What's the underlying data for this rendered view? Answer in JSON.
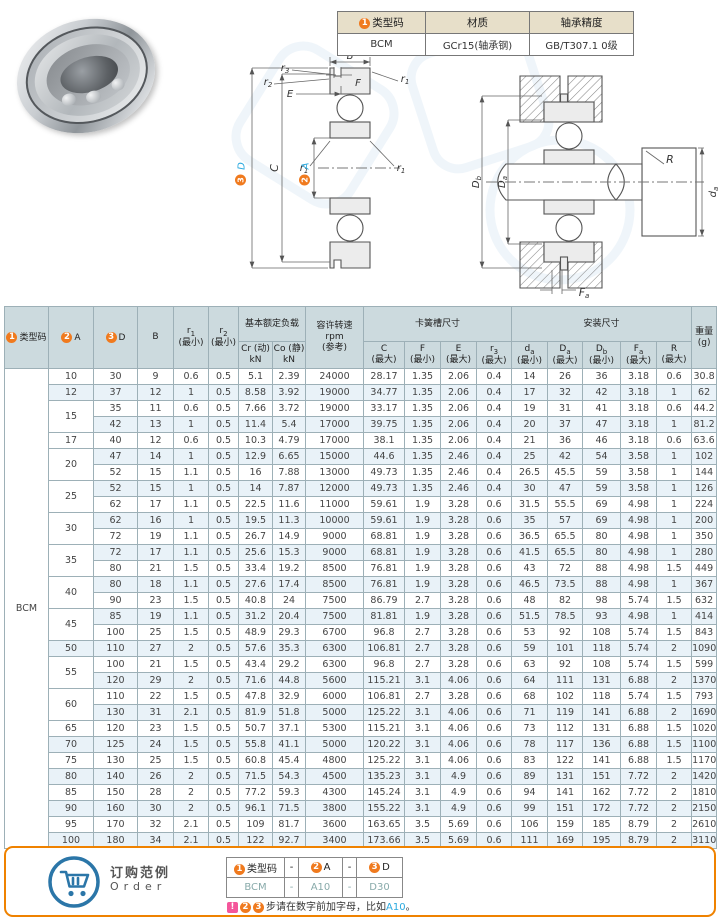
{
  "colors": {
    "accent_cyan": "#2aa9df",
    "accent_orange": "#f07a1e",
    "table_header_bg": "#ccdade",
    "row_alt_bg": "#e9f2f8",
    "info_header_bg": "#e7dfc9",
    "panel_border": "#ef8200",
    "warn_pink": "#f4569b",
    "cart_blue": "#2b76a8"
  },
  "info": {
    "h1": "类型码",
    "h2": "材质",
    "h3": "轴承精度",
    "v1": "BCM",
    "v2": "GCr15(轴承钢)",
    "v3": "GB/T307.1 0级"
  },
  "badges": {
    "b1": "1",
    "b2": "2",
    "b3": "3"
  },
  "th": {
    "typecode": "类型码",
    "colA": "A",
    "colD": "D",
    "colB": "B",
    "r": "r",
    "s1": "1",
    "s2": "2",
    "s3": "3",
    "min": "(最小)",
    "max": "(最大)",
    "load_group": "基本额定负载",
    "cr1": "Cr (动)",
    "co1": "Co (静)",
    "kn": "kN",
    "speed1": "容许转速",
    "speed2": "rpm",
    "speed3": "(参考)",
    "snap_group": "卡簧槽尺寸",
    "c": "C",
    "f": "F",
    "e": "E",
    "mount_group": "安装尺寸",
    "dlow": "d",
    "dup": "D",
    "fup": "F",
    "R": "R",
    "sa": "a",
    "sb": "b",
    "weight1": "重量",
    "weight2": "(g)"
  },
  "main_table": {
    "type_code": "BCM",
    "rows": [
      [
        "10",
        1,
        "30",
        "9",
        "0.6",
        "0.5",
        "5.1",
        "2.39",
        "24000",
        "28.17",
        "1.35",
        "2.06",
        "0.4",
        "14",
        "26",
        "36",
        "3.18",
        "0.6",
        "30.8"
      ],
      [
        "12",
        1,
        "37",
        "12",
        "1",
        "0.5",
        "8.58",
        "3.92",
        "19000",
        "34.77",
        "1.35",
        "2.06",
        "0.4",
        "17",
        "32",
        "42",
        "3.18",
        "1",
        "62"
      ],
      [
        "15",
        2,
        "35",
        "11",
        "0.6",
        "0.5",
        "7.66",
        "3.72",
        "19000",
        "33.17",
        "1.35",
        "2.06",
        "0.4",
        "19",
        "31",
        "41",
        "3.18",
        "0.6",
        "44.2"
      ],
      [
        null,
        0,
        "42",
        "13",
        "1",
        "0.5",
        "11.4",
        "5.4",
        "17000",
        "39.75",
        "1.35",
        "2.06",
        "0.4",
        "20",
        "37",
        "47",
        "3.18",
        "1",
        "81.2"
      ],
      [
        "17",
        1,
        "40",
        "12",
        "0.6",
        "0.5",
        "10.3",
        "4.79",
        "17000",
        "38.1",
        "1.35",
        "2.06",
        "0.4",
        "21",
        "36",
        "46",
        "3.18",
        "0.6",
        "63.6"
      ],
      [
        "20",
        2,
        "47",
        "14",
        "1",
        "0.5",
        "12.9",
        "6.65",
        "15000",
        "44.6",
        "1.35",
        "2.46",
        "0.4",
        "25",
        "42",
        "54",
        "3.58",
        "1",
        "102"
      ],
      [
        null,
        0,
        "52",
        "15",
        "1.1",
        "0.5",
        "16",
        "7.88",
        "13000",
        "49.73",
        "1.35",
        "2.46",
        "0.4",
        "26.5",
        "45.5",
        "59",
        "3.58",
        "1",
        "144"
      ],
      [
        "25",
        2,
        "52",
        "15",
        "1",
        "0.5",
        "14",
        "7.87",
        "12000",
        "49.73",
        "1.35",
        "2.46",
        "0.4",
        "30",
        "47",
        "59",
        "3.58",
        "1",
        "126"
      ],
      [
        null,
        0,
        "62",
        "17",
        "1.1",
        "0.5",
        "22.5",
        "11.6",
        "11000",
        "59.61",
        "1.9",
        "3.28",
        "0.6",
        "31.5",
        "55.5",
        "69",
        "4.98",
        "1",
        "224"
      ],
      [
        "30",
        2,
        "62",
        "16",
        "1",
        "0.5",
        "19.5",
        "11.3",
        "10000",
        "59.61",
        "1.9",
        "3.28",
        "0.6",
        "35",
        "57",
        "69",
        "4.98",
        "1",
        "200"
      ],
      [
        null,
        0,
        "72",
        "19",
        "1.1",
        "0.5",
        "26.7",
        "14.9",
        "9000",
        "68.81",
        "1.9",
        "3.28",
        "0.6",
        "36.5",
        "65.5",
        "80",
        "4.98",
        "1",
        "350"
      ],
      [
        "35",
        2,
        "72",
        "17",
        "1.1",
        "0.5",
        "25.6",
        "15.3",
        "9000",
        "68.81",
        "1.9",
        "3.28",
        "0.6",
        "41.5",
        "65.5",
        "80",
        "4.98",
        "1",
        "280"
      ],
      [
        null,
        0,
        "80",
        "21",
        "1.5",
        "0.5",
        "33.4",
        "19.2",
        "8500",
        "76.81",
        "1.9",
        "3.28",
        "0.6",
        "43",
        "72",
        "88",
        "4.98",
        "1.5",
        "449"
      ],
      [
        "40",
        2,
        "80",
        "18",
        "1.1",
        "0.5",
        "27.6",
        "17.4",
        "8500",
        "76.81",
        "1.9",
        "3.28",
        "0.6",
        "46.5",
        "73.5",
        "88",
        "4.98",
        "1",
        "367"
      ],
      [
        null,
        0,
        "90",
        "23",
        "1.5",
        "0.5",
        "40.8",
        "24",
        "7500",
        "86.79",
        "2.7",
        "3.28",
        "0.6",
        "48",
        "82",
        "98",
        "5.74",
        "1.5",
        "632"
      ],
      [
        "45",
        2,
        "85",
        "19",
        "1.1",
        "0.5",
        "31.2",
        "20.4",
        "7500",
        "81.81",
        "1.9",
        "3.28",
        "0.6",
        "51.5",
        "78.5",
        "93",
        "4.98",
        "1",
        "414"
      ],
      [
        null,
        0,
        "100",
        "25",
        "1.5",
        "0.5",
        "48.9",
        "29.3",
        "6700",
        "96.8",
        "2.7",
        "3.28",
        "0.6",
        "53",
        "92",
        "108",
        "5.74",
        "1.5",
        "843"
      ],
      [
        "50",
        1,
        "110",
        "27",
        "2",
        "0.5",
        "57.6",
        "35.3",
        "6300",
        "106.81",
        "2.7",
        "3.28",
        "0.6",
        "59",
        "101",
        "118",
        "5.74",
        "2",
        "1090"
      ],
      [
        "55",
        2,
        "100",
        "21",
        "1.5",
        "0.5",
        "43.4",
        "29.2",
        "6300",
        "96.8",
        "2.7",
        "3.28",
        "0.6",
        "63",
        "92",
        "108",
        "5.74",
        "1.5",
        "599"
      ],
      [
        null,
        0,
        "120",
        "29",
        "2",
        "0.5",
        "71.6",
        "44.8",
        "5600",
        "115.21",
        "3.1",
        "4.06",
        "0.6",
        "64",
        "111",
        "131",
        "6.88",
        "2",
        "1370"
      ],
      [
        "60",
        2,
        "110",
        "22",
        "1.5",
        "0.5",
        "47.8",
        "32.9",
        "6000",
        "106.81",
        "2.7",
        "3.28",
        "0.6",
        "68",
        "102",
        "118",
        "5.74",
        "1.5",
        "793"
      ],
      [
        null,
        0,
        "130",
        "31",
        "2.1",
        "0.5",
        "81.9",
        "51.8",
        "5000",
        "125.22",
        "3.1",
        "4.06",
        "0.6",
        "71",
        "119",
        "141",
        "6.88",
        "2",
        "1690"
      ],
      [
        "65",
        1,
        "120",
        "23",
        "1.5",
        "0.5",
        "50.7",
        "37.1",
        "5300",
        "115.21",
        "3.1",
        "4.06",
        "0.6",
        "73",
        "112",
        "131",
        "6.88",
        "1.5",
        "1020"
      ],
      [
        "70",
        1,
        "125",
        "24",
        "1.5",
        "0.5",
        "55.8",
        "41.1",
        "5000",
        "120.22",
        "3.1",
        "4.06",
        "0.6",
        "78",
        "117",
        "136",
        "6.88",
        "1.5",
        "1100"
      ],
      [
        "75",
        1,
        "130",
        "25",
        "1.5",
        "0.5",
        "60.8",
        "45.4",
        "4800",
        "125.22",
        "3.1",
        "4.06",
        "0.6",
        "83",
        "122",
        "141",
        "6.88",
        "1.5",
        "1170"
      ],
      [
        "80",
        1,
        "140",
        "26",
        "2",
        "0.5",
        "71.5",
        "54.3",
        "4500",
        "135.23",
        "3.1",
        "4.9",
        "0.6",
        "89",
        "131",
        "151",
        "7.72",
        "2",
        "1420"
      ],
      [
        "85",
        1,
        "150",
        "28",
        "2",
        "0.5",
        "77.2",
        "59.3",
        "4300",
        "145.24",
        "3.1",
        "4.9",
        "0.6",
        "94",
        "141",
        "162",
        "7.72",
        "2",
        "1810"
      ],
      [
        "90",
        1,
        "160",
        "30",
        "2",
        "0.5",
        "96.1",
        "71.5",
        "3800",
        "155.22",
        "3.1",
        "4.9",
        "0.6",
        "99",
        "151",
        "172",
        "7.72",
        "2",
        "2150"
      ],
      [
        "95",
        1,
        "170",
        "32",
        "2.1",
        "0.5",
        "109",
        "81.7",
        "3600",
        "163.65",
        "3.5",
        "5.69",
        "0.6",
        "106",
        "159",
        "185",
        "8.79",
        "2",
        "2610"
      ],
      [
        "100",
        1,
        "180",
        "34",
        "2.1",
        "0.5",
        "122",
        "92.7",
        "3400",
        "173.66",
        "3.5",
        "5.69",
        "0.6",
        "111",
        "169",
        "195",
        "8.79",
        "2",
        "3110"
      ]
    ]
  },
  "order": {
    "title_cn": "订购范例",
    "title_en": "Order",
    "dash": "-",
    "code": "BCM",
    "a_val": "A10",
    "d_val": "D30",
    "warn": "!",
    "note": "步请在数字前加字母，比如",
    "note_example": "A10",
    "note_end": "。"
  }
}
